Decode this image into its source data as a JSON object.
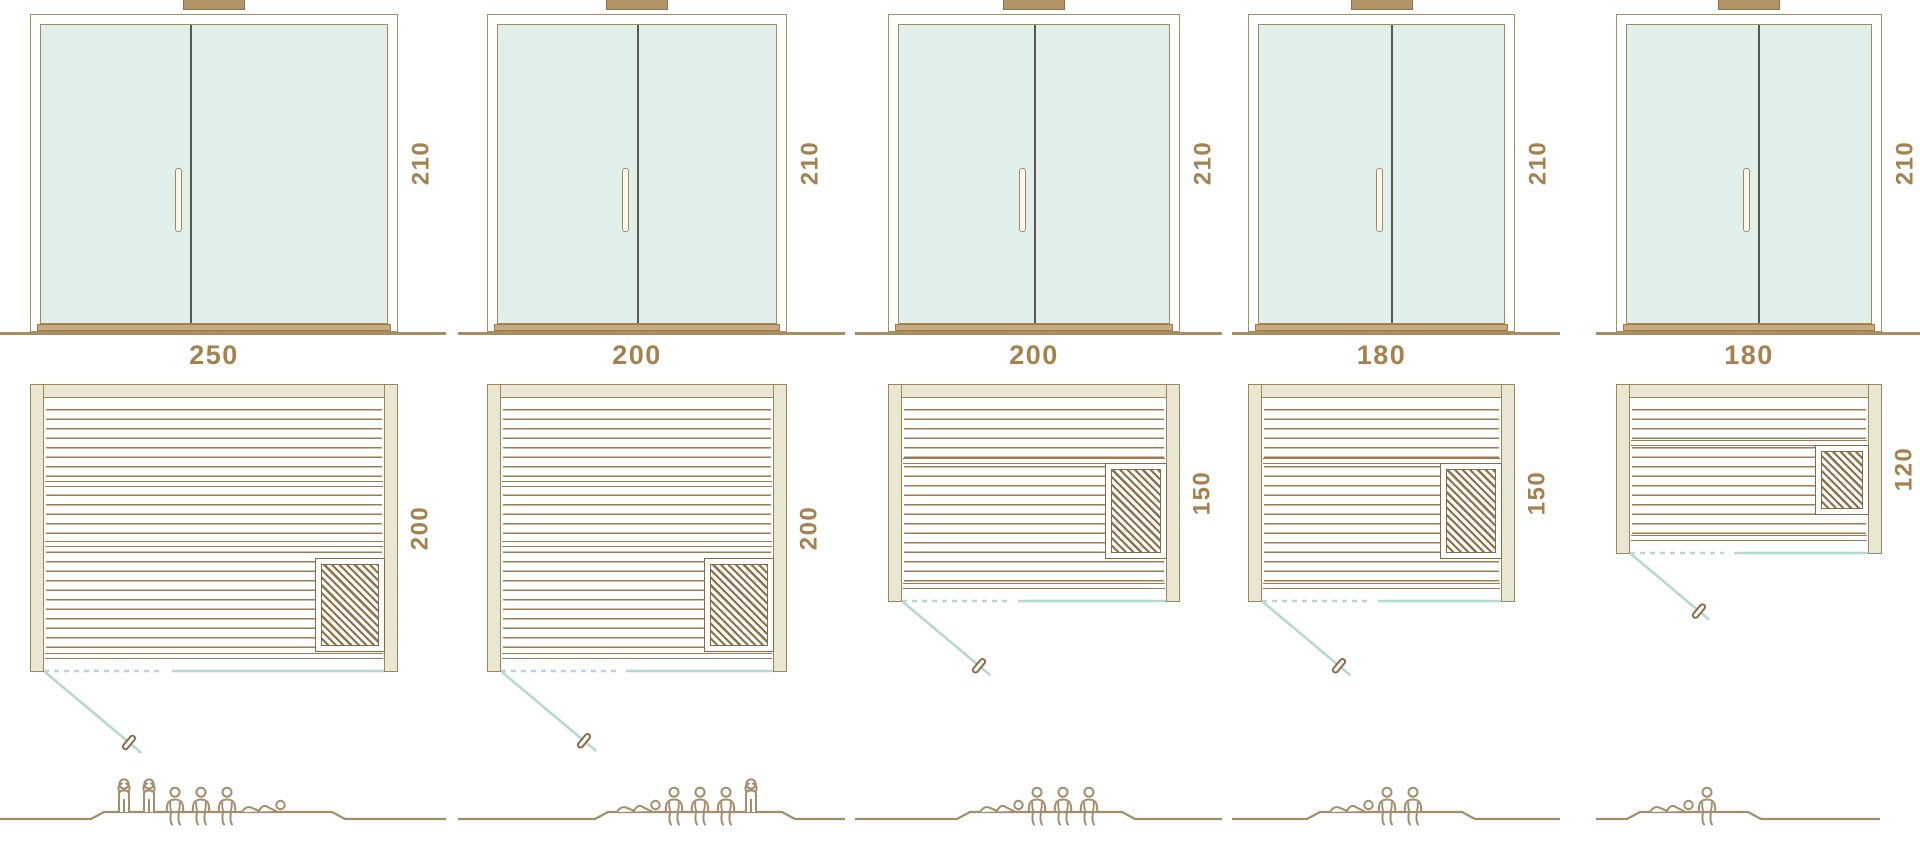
{
  "diagram": {
    "kind": "sauna size comparison drawings",
    "views": [
      "front-elevation",
      "floor-plan",
      "capacity-figures"
    ]
  },
  "colors": {
    "line_brown": "#9d7b51",
    "frame_brown": "#ab8d60",
    "wall_fill": "#e9e6d2",
    "glass_fill": "#e1efeb",
    "door_divider": "#5a564c",
    "threshold": "#c9aa7d",
    "chimney": "#b39468",
    "teal_door_swing": "#b5d8d1",
    "dimension_text": "#a5814e",
    "people_outline": "#a38d6b",
    "heater_lattice": "#8f6f45",
    "ground": "#a98c5f"
  },
  "saunas": [
    {
      "elevation": {
        "height_label": "210"
      },
      "plan": {
        "width_label": "250",
        "depth_label": "200"
      },
      "dimensions_cm": {
        "width": 250,
        "depth": 200,
        "height": 210
      },
      "capacity": {
        "standing": 2,
        "sitting": 3,
        "lying": 1
      },
      "figures": [
        "standing",
        "standing",
        "sitting",
        "sitting",
        "sitting",
        "lying"
      ]
    },
    {
      "elevation": {
        "height_label": "210"
      },
      "plan": {
        "width_label": "200",
        "depth_label": "200"
      },
      "dimensions_cm": {
        "width": 200,
        "depth": 200,
        "height": 210
      },
      "capacity": {
        "standing": 1,
        "sitting": 3,
        "lying": 1
      },
      "figures": [
        "lying",
        "sitting",
        "sitting",
        "sitting",
        "standing"
      ]
    },
    {
      "elevation": {
        "height_label": "210"
      },
      "plan": {
        "width_label": "200",
        "depth_label": "150"
      },
      "dimensions_cm": {
        "width": 200,
        "depth": 150,
        "height": 210
      },
      "capacity": {
        "standing": 0,
        "sitting": 3,
        "lying": 1
      },
      "figures": [
        "lying",
        "sitting",
        "sitting",
        "sitting"
      ]
    },
    {
      "elevation": {
        "height_label": "210"
      },
      "plan": {
        "width_label": "180",
        "depth_label": "150"
      },
      "dimensions_cm": {
        "width": 180,
        "depth": 150,
        "height": 210
      },
      "capacity": {
        "standing": 0,
        "sitting": 2,
        "lying": 1
      },
      "figures": [
        "lying",
        "sitting",
        "sitting"
      ]
    },
    {
      "elevation": {
        "height_label": "210"
      },
      "plan": {
        "width_label": "180",
        "depth_label": "120"
      },
      "dimensions_cm": {
        "width": 180,
        "depth": 120,
        "height": 210
      },
      "capacity": {
        "standing": 0,
        "sitting": 1,
        "lying": 1
      },
      "figures": [
        "lying",
        "sitting"
      ]
    }
  ]
}
